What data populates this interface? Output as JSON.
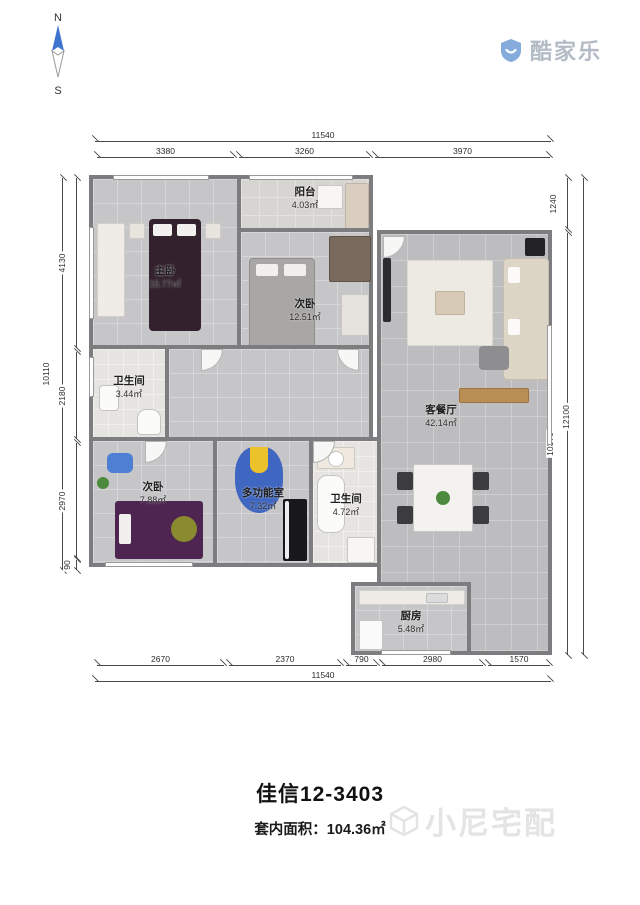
{
  "compass": {
    "north": "N",
    "south": "S"
  },
  "logo": {
    "brand": "酷家乐"
  },
  "floorplan": {
    "rooms": [
      {
        "name": "阳台",
        "area": "4.03㎡"
      },
      {
        "name": "主卧",
        "area": "15.77㎡"
      },
      {
        "name": "次卧",
        "area": "12.51㎡"
      },
      {
        "name": "卫生间",
        "area": "3.44㎡"
      },
      {
        "name": "客餐厅",
        "area": "42.14㎡"
      },
      {
        "name": "次卧",
        "area": "7.88㎡"
      },
      {
        "name": "多功能室",
        "area": "7.32㎡"
      },
      {
        "name": "卫生间",
        "area": "4.72㎡"
      },
      {
        "name": "厨房",
        "area": "5.48㎡"
      }
    ],
    "dims": {
      "top_total": "11540",
      "top": [
        "3380",
        "3260",
        "3970"
      ],
      "bottom": [
        "2670",
        "2370",
        "790",
        "2980",
        "1570"
      ],
      "bottom_total": "11540",
      "left": [
        "4130",
        "2180",
        "2970",
        "90"
      ],
      "left_total": "10110",
      "right": [
        "1240",
        "10370"
      ],
      "right_total": "12100"
    }
  },
  "footer": {
    "title": "佳信12-3403",
    "area_label": "套内面积：104.36㎡",
    "watermark": "小尼宅配"
  },
  "colors": {
    "compass_blue": "#3e74cf",
    "logo_blue": "#85abdc",
    "wall_gray": "#7d7c7f"
  }
}
